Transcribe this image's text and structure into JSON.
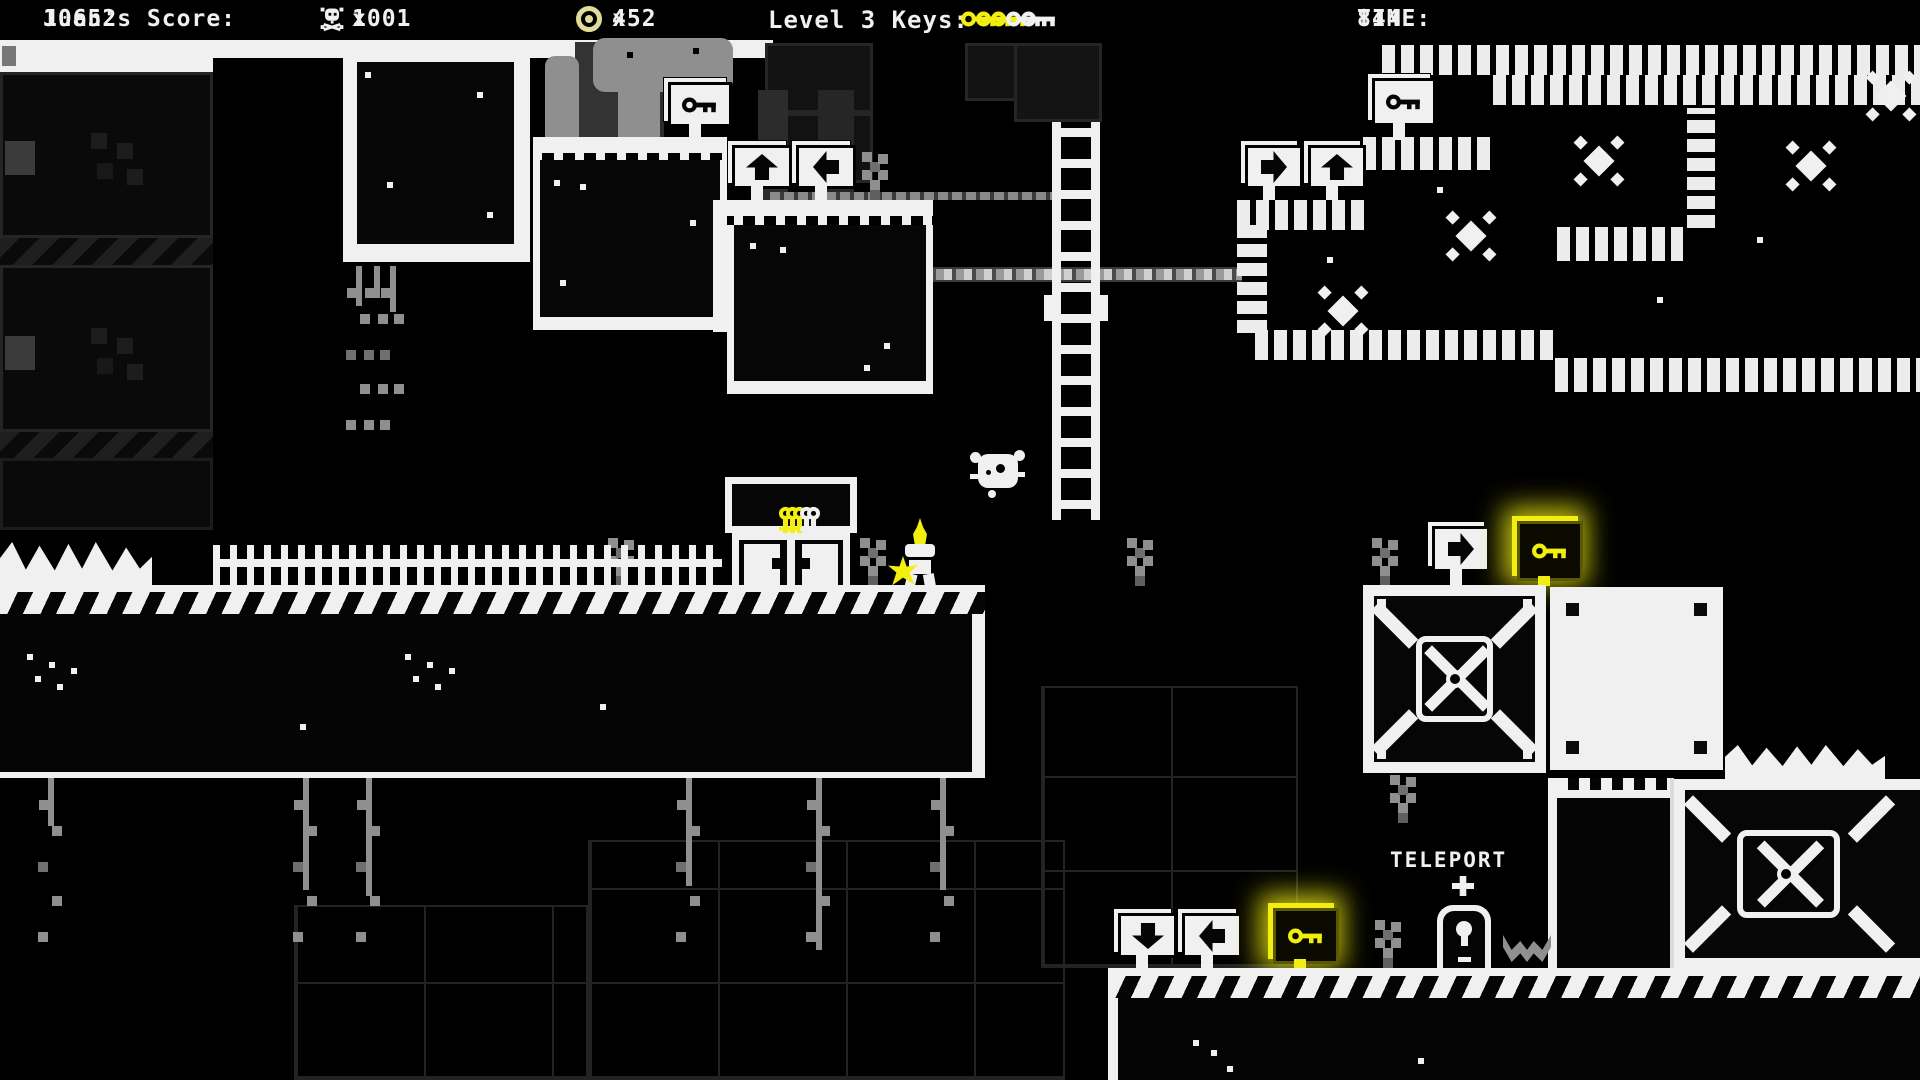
{
  "hud": {
    "score_label": "Juan's Score:",
    "score_value": "10652",
    "times_sign": "x",
    "skull_icon": "skull-crossbones-icon",
    "skull_count": "1001",
    "coin_icon": "coin-icon",
    "coin_count": "452",
    "keys_label": "Level 3 Keys:",
    "keys": {
      "total": 5,
      "collected": 3
    },
    "time_label": "TIME:",
    "time_value": "844"
  },
  "world": {
    "teleport_label": "TELEPORT",
    "key_door": {
      "slots": 5,
      "filled": 3
    },
    "signs": [
      {
        "id": "sign-key-upper",
        "glyph": "key-icon",
        "style": "white"
      },
      {
        "id": "sign-arrow-up-mid",
        "glyph": "arrow-up-icon",
        "style": "white"
      },
      {
        "id": "sign-arrow-left-mid",
        "glyph": "arrow-left-icon",
        "style": "white"
      },
      {
        "id": "sign-arrow-right-cave",
        "glyph": "arrow-right-icon",
        "style": "white"
      },
      {
        "id": "sign-arrow-up-cave",
        "glyph": "arrow-up-icon",
        "style": "white"
      },
      {
        "id": "sign-key-cave",
        "glyph": "key-icon",
        "style": "white"
      },
      {
        "id": "sign-arrow-right-crates",
        "glyph": "arrow-right-icon",
        "style": "white"
      },
      {
        "id": "sign-key-glow-crates",
        "glyph": "key-icon",
        "style": "glow"
      },
      {
        "id": "sign-arrow-down-bottom",
        "glyph": "arrow-down-icon",
        "style": "white"
      },
      {
        "id": "sign-arrow-left-bottom",
        "glyph": "arrow-left-icon",
        "style": "white"
      },
      {
        "id": "sign-key-glow-bottom",
        "glyph": "key-icon",
        "style": "glow"
      }
    ],
    "entities": [
      "player",
      "skull-enemy",
      "teleporter",
      "ladder",
      "key-door-machine"
    ]
  },
  "colors": {
    "background": "#000000",
    "foreground": "#f0f0f0",
    "accent_yellow": "#f2ee10",
    "gray": "#8f8f8f",
    "coin": "#dedc96"
  }
}
